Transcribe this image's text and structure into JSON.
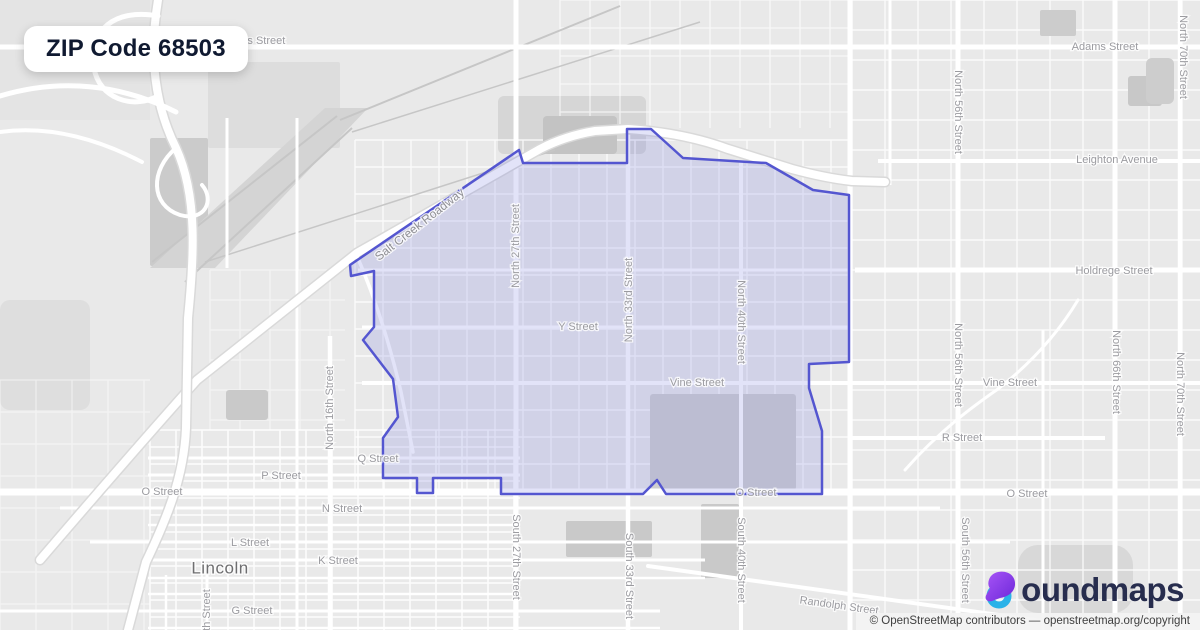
{
  "header": {
    "badge_title": "ZIP Code 68503"
  },
  "branding": {
    "logo_icon": "boundmaps-b-icon",
    "logo_text": "oundmaps",
    "icon_purple": "#8b3dee",
    "icon_purple_dark": "#6d28d9",
    "icon_cyan": "#2ab2e8"
  },
  "attribution": {
    "text": "© OpenStreetMap contributors — openstreetmap.org/copyright"
  },
  "map": {
    "colors": {
      "bg": "#e9e9e9",
      "road": "#ffffff",
      "casing": "#d9d9d9",
      "rail": "#c6c6c6"
    },
    "boundary": {
      "zip": "68503",
      "fill": "rgba(123,127,224,0.22)",
      "stroke": "#5456d0",
      "stroke_width": 2.5,
      "points": "519,150 523,163 627,163 627,129 651,129 683,158 766,163 813,190 849,195 849,362 809,364 809,388 822,431 822,494 666,494 657,480 643,494 501,494 501,478 433,478 433,493 417,493 417,478 383,478 383,438 398,417 393,379 363,340 374,327 374,271 351,276 350,265"
    },
    "patches": [
      {
        "x": 0,
        "y": 0,
        "w": 150,
        "h": 120,
        "fill": "#e4e4e4",
        "rx": 0,
        "layer": 1
      },
      {
        "x": 150,
        "y": 138,
        "w": 58,
        "h": 128,
        "fill": "#cbcbcb",
        "rx": 2,
        "layer": 1
      },
      {
        "x": 208,
        "y": 62,
        "w": 132,
        "h": 86,
        "fill": "#dddddd",
        "rx": 2,
        "layer": 1
      },
      {
        "x": 498,
        "y": 96,
        "w": 148,
        "h": 58,
        "fill": "#d6d6d6",
        "rx": 6,
        "layer": 1
      },
      {
        "x": 0,
        "y": 300,
        "w": 90,
        "h": 110,
        "fill": "#dedede",
        "rx": 10,
        "layer": 1
      },
      {
        "x": 1018,
        "y": 545,
        "w": 115,
        "h": 68,
        "fill": "#d8d8d8",
        "rx": 20,
        "layer": 1
      },
      {
        "x": 543,
        "y": 116,
        "w": 74,
        "h": 38,
        "fill": "#c3c3c3",
        "rx": 4,
        "layer": 2
      },
      {
        "x": 650,
        "y": 394,
        "w": 146,
        "h": 96,
        "fill": "#cfcfcf",
        "rx": 3,
        "layer": 2
      },
      {
        "x": 566,
        "y": 521,
        "w": 86,
        "h": 36,
        "fill": "#c9c9c9",
        "rx": 2,
        "layer": 2
      },
      {
        "x": 701,
        "y": 504,
        "w": 38,
        "h": 74,
        "fill": "#c9c9c9",
        "rx": 2,
        "layer": 2
      },
      {
        "x": 1128,
        "y": 76,
        "w": 34,
        "h": 30,
        "fill": "#c8c8c8",
        "rx": 3,
        "layer": 2
      },
      {
        "x": 1146,
        "y": 58,
        "w": 28,
        "h": 46,
        "fill": "#cdcdcd",
        "rx": 6,
        "layer": 2
      },
      {
        "x": 1040,
        "y": 10,
        "w": 36,
        "h": 26,
        "fill": "#cccccc",
        "rx": 2,
        "layer": 2
      },
      {
        "x": 226,
        "y": 390,
        "w": 42,
        "h": 30,
        "fill": "#c9c9c9",
        "rx": 3,
        "layer": 2
      }
    ],
    "special_patches": [
      {
        "d": "M325,108 L368,108 L215,268 L150,268 Z",
        "fill": "#d4d4d4"
      }
    ],
    "grids": [
      {
        "x0": 150,
        "y0": 430,
        "x1": 520,
        "y1": 630,
        "dx": 26,
        "dy": 17,
        "w": 1.6,
        "op": 0.9
      },
      {
        "x0": 355,
        "y0": 140,
        "x1": 850,
        "y1": 492,
        "dx": 28,
        "dy": 27,
        "w": 1.4,
        "op": 0.8
      },
      {
        "x0": 852,
        "y0": 0,
        "x1": 1200,
        "y1": 613,
        "dx": 33,
        "dy": 30,
        "w": 1.4,
        "op": 0.8
      },
      {
        "x0": 560,
        "y0": 0,
        "x1": 850,
        "y1": 128,
        "dx": 30,
        "dy": 28,
        "w": 1.3,
        "op": 0.7
      },
      {
        "x0": 0,
        "y0": 380,
        "x1": 150,
        "y1": 630,
        "dx": 36,
        "dy": 32,
        "w": 1.2,
        "op": 0.5
      },
      {
        "x0": 210,
        "y0": 270,
        "x1": 345,
        "y1": 430,
        "dx": 30,
        "dy": 30,
        "w": 1.2,
        "op": 0.5
      }
    ],
    "rails": [
      {
        "d": "M337,116 L152,262",
        "w": 2
      },
      {
        "d": "M352,128 L185,282",
        "w": 2
      },
      {
        "d": "M340,120 L620,6",
        "w": 2
      },
      {
        "d": "M352,132 L700,22",
        "w": 1.5
      },
      {
        "d": "M205,262 L555,150",
        "w": 1.5
      }
    ],
    "roads_h": [
      {
        "y": 47,
        "x1": 0,
        "x2": 1200,
        "w": 5
      },
      {
        "y": 161,
        "x1": 878,
        "x2": 1200,
        "w": 4
      },
      {
        "y": 270,
        "x1": 855,
        "x2": 1200,
        "w": 5
      },
      {
        "y": 270,
        "x1": 358,
        "x2": 850,
        "w": 3
      },
      {
        "y": 327,
        "x1": 362,
        "x2": 848,
        "w": 3
      },
      {
        "y": 383,
        "x1": 362,
        "x2": 1200,
        "w": 4
      },
      {
        "y": 438,
        "x1": 852,
        "x2": 1105,
        "w": 4
      },
      {
        "y": 492,
        "x1": 0,
        "x2": 1200,
        "w": 7
      },
      {
        "y": 458,
        "x1": 148,
        "x2": 520,
        "w": 3
      },
      {
        "y": 475,
        "x1": 148,
        "x2": 520,
        "w": 3
      },
      {
        "y": 508,
        "x1": 60,
        "x2": 940,
        "w": 3
      },
      {
        "y": 525,
        "x1": 148,
        "x2": 520,
        "w": 2.5
      },
      {
        "y": 542,
        "x1": 90,
        "x2": 1010,
        "w": 3
      },
      {
        "y": 560,
        "x1": 148,
        "x2": 705,
        "w": 3
      },
      {
        "y": 578,
        "x1": 148,
        "x2": 705,
        "w": 2.5
      },
      {
        "y": 594,
        "x1": 148,
        "x2": 520,
        "w": 2.5
      },
      {
        "y": 611,
        "x1": 0,
        "x2": 660,
        "w": 3
      },
      {
        "y": 628,
        "x1": 148,
        "x2": 660,
        "w": 2.5
      }
    ],
    "roads_v": [
      {
        "x": 297,
        "y1": 118,
        "y2": 630,
        "w": 3
      },
      {
        "x": 330,
        "y1": 336,
        "y2": 630,
        "w": 4.5
      },
      {
        "x": 516,
        "y1": 0,
        "y2": 630,
        "w": 5
      },
      {
        "x": 628,
        "y1": 128,
        "y2": 630,
        "w": 4.5
      },
      {
        "x": 741,
        "y1": 162,
        "y2": 630,
        "w": 4
      },
      {
        "x": 850,
        "y1": 0,
        "y2": 630,
        "w": 5
      },
      {
        "x": 958,
        "y1": 0,
        "y2": 630,
        "w": 5
      },
      {
        "x": 1115,
        "y1": 0,
        "y2": 630,
        "w": 5
      },
      {
        "x": 1180,
        "y1": 0,
        "y2": 630,
        "w": 4.5
      },
      {
        "x": 890,
        "y1": 0,
        "y2": 185,
        "w": 3
      },
      {
        "x": 227,
        "y1": 118,
        "y2": 268,
        "w": 3
      },
      {
        "x": 166,
        "y1": 575,
        "y2": 630,
        "w": 2.5
      },
      {
        "x": 207,
        "y1": 575,
        "y2": 630,
        "w": 3
      },
      {
        "x": 1043,
        "y1": 330,
        "y2": 630,
        "w": 3
      }
    ],
    "highways": [
      {
        "d": "M40,560 Q130,455 197,380 L357,253 L540,149 Q565,136 595,131 L628,129 Q685,133 728,149 L792,169 Q825,178 852,181 L885,182",
        "w": 8,
        "casing": true
      },
      {
        "d": "M158,0 C148,60 156,108 176,148 C198,196 194,258 188,318 L186,428 C184,478 166,520 146,562 L128,630",
        "w": 8,
        "casing": true
      },
      {
        "d": "M158,16 C115,8 88,30 94,68 C99,98 132,110 158,96",
        "w": 5,
        "casing": false
      },
      {
        "d": "M0,96 C60,78 120,84 176,112",
        "w": 5,
        "casing": false
      },
      {
        "d": "M0,132 C44,126 92,136 142,162",
        "w": 4,
        "casing": false
      },
      {
        "d": "M176,148 C150,170 150,205 180,215 C205,222 215,200 202,185",
        "w": 4,
        "casing": false
      },
      {
        "d": "M357,256 C376,300 390,345 401,392 L413,452",
        "w": 3.5,
        "casing": false
      },
      {
        "d": "M648,566 L1200,643",
        "w": 4,
        "casing": false
      },
      {
        "d": "M905,470 C940,430 975,405 998,389",
        "w": 3,
        "casing": false
      },
      {
        "d": "M998,389 C1035,360 1060,330 1078,300",
        "w": 3,
        "casing": false
      }
    ],
    "labels": [
      {
        "t": "Adams Street",
        "x": 252,
        "y": 41,
        "r": 0
      },
      {
        "t": "Adams Street",
        "x": 1105,
        "y": 47,
        "r": 0
      },
      {
        "t": "Leighton Avenue",
        "x": 1117,
        "y": 160,
        "r": 0
      },
      {
        "t": "Holdrege Street",
        "x": 1114,
        "y": 271,
        "r": 0
      },
      {
        "t": "Vine Street",
        "x": 1010,
        "y": 383,
        "r": 0
      },
      {
        "t": "R Street",
        "x": 962,
        "y": 438,
        "r": 0
      },
      {
        "t": "O Street",
        "x": 1027,
        "y": 494,
        "r": 0
      },
      {
        "t": "O Street",
        "x": 162,
        "y": 492,
        "r": 0
      },
      {
        "t": "P Street",
        "x": 281,
        "y": 476,
        "r": 0
      },
      {
        "t": "Q Street",
        "x": 378,
        "y": 459,
        "r": 0
      },
      {
        "t": "N Street",
        "x": 342,
        "y": 509,
        "r": 0
      },
      {
        "t": "L Street",
        "x": 250,
        "y": 543,
        "r": 0
      },
      {
        "t": "K Street",
        "x": 338,
        "y": 561,
        "r": 0
      },
      {
        "t": "G Street",
        "x": 252,
        "y": 611,
        "r": 0
      },
      {
        "t": "Y Street",
        "x": 578,
        "y": 327,
        "r": 0
      },
      {
        "t": "Vine Street",
        "x": 697,
        "y": 383,
        "r": 0
      },
      {
        "t": "O Street",
        "x": 756,
        "y": 493,
        "r": 0
      },
      {
        "t": "Randolph Street",
        "x": 839,
        "y": 606,
        "r": 8
      },
      {
        "t": "Salt Creek Roadway",
        "x": 420,
        "y": 225,
        "r": -38,
        "c": "hwy"
      },
      {
        "t": "Lincoln",
        "x": 220,
        "y": 569,
        "r": 0,
        "c": "city"
      },
      {
        "t": "North 16th Street",
        "x": 330,
        "y": 408,
        "r": -90
      },
      {
        "t": "North 27th Street",
        "x": 516,
        "y": 246,
        "r": -90
      },
      {
        "t": "North 33rd Street",
        "x": 629,
        "y": 300,
        "r": -90
      },
      {
        "t": "North 40th Street",
        "x": 741,
        "y": 322,
        "r": 90
      },
      {
        "t": "North 56th Street",
        "x": 958,
        "y": 112,
        "r": 90
      },
      {
        "t": "North 56th Street",
        "x": 958,
        "y": 365,
        "r": 90
      },
      {
        "t": "North 66th Street",
        "x": 1116,
        "y": 372,
        "r": 90
      },
      {
        "t": "North 70th Street",
        "x": 1183,
        "y": 57,
        "r": 90
      },
      {
        "t": "North 70th Street",
        "x": 1180,
        "y": 394,
        "r": 90
      },
      {
        "t": "South 27th Street",
        "x": 516,
        "y": 557,
        "r": 90
      },
      {
        "t": "South 33rd Street",
        "x": 629,
        "y": 576,
        "r": 90
      },
      {
        "t": "South 40th Street",
        "x": 741,
        "y": 560,
        "r": 90
      },
      {
        "t": "South 56th Street",
        "x": 965,
        "y": 560,
        "r": 90
      },
      {
        "t": "th Street",
        "x": 207,
        "y": 610,
        "r": -90
      }
    ]
  }
}
